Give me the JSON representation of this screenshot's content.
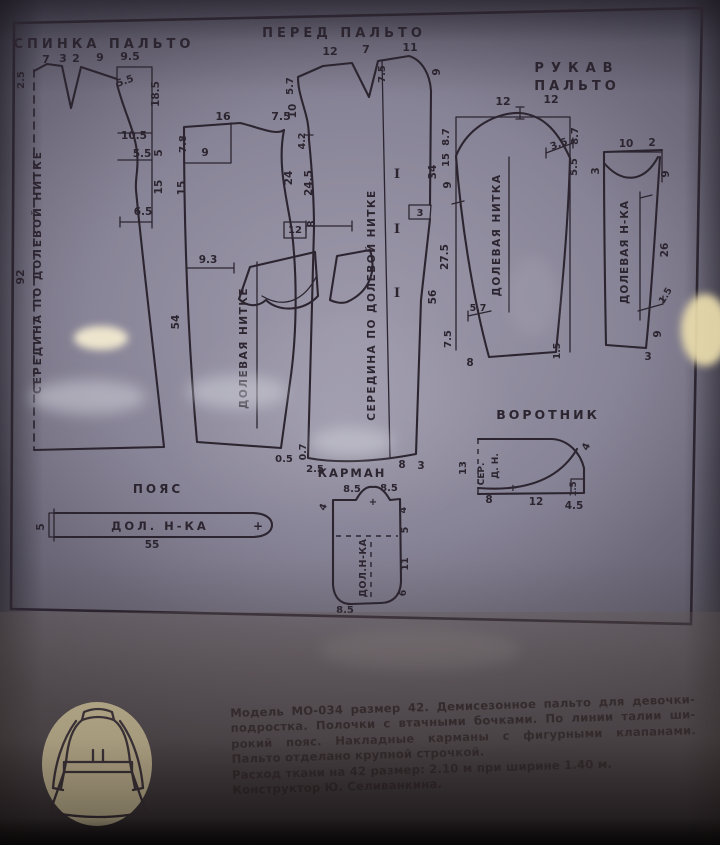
{
  "colors": {
    "line": "#2c2530",
    "logo_circle": "#e9dcae",
    "caption_text": "#221a20",
    "glare": "#f3ead0"
  },
  "sheet": {
    "titles": {
      "back": "СПИНКА ПАЛЬТО",
      "front": "ПЕРЕД ПАЛЬТО",
      "sleeve1": "РУКАВ",
      "sleeve2": "ПАЛЬТО",
      "collar": "ВОРОТНИК",
      "belt": "ПОЯС",
      "pocket": "КАРМАН"
    },
    "labels": [
      {
        "t": "7",
        "x": 46,
        "y": 63
      },
      {
        "t": "3",
        "x": 63,
        "y": 62
      },
      {
        "t": "2",
        "x": 76,
        "y": 62
      },
      {
        "t": "9",
        "x": 100,
        "y": 61
      },
      {
        "t": "9.5",
        "x": 130,
        "y": 60
      },
      {
        "t": "2.5",
        "x": 24,
        "y": 80,
        "r": -90,
        "s": 10
      },
      {
        "t": "5.5",
        "x": 126,
        "y": 84,
        "r": -20,
        "s": 10
      },
      {
        "t": "18.5",
        "x": 159,
        "y": 94,
        "r": -90,
        "s": 10.5
      },
      {
        "t": "10.5",
        "x": 134,
        "y": 139,
        "s": 10.5
      },
      {
        "t": "5.5",
        "x": 142,
        "y": 157,
        "s": 10.5
      },
      {
        "t": "5",
        "x": 162,
        "y": 153,
        "r": -90,
        "s": 10.5
      },
      {
        "t": "15",
        "x": 162,
        "y": 187,
        "r": -90,
        "s": 10.5
      },
      {
        "t": "6.5",
        "x": 143,
        "y": 215,
        "s": 10.5
      },
      {
        "t": "92",
        "x": 24,
        "y": 277,
        "r": -90,
        "s": 11
      },
      {
        "t": "СЕРЕДИНА  ПО  ДОЛЕВОЙ  НИТКЕ",
        "x": 41,
        "y": 272,
        "r": -90,
        "s": 10.5,
        "ls": 2,
        "n": "back-grainline-label"
      },
      {
        "t": "16",
        "x": 223,
        "y": 120
      },
      {
        "t": "7.5",
        "x": 281,
        "y": 120
      },
      {
        "t": "7.8",
        "x": 186,
        "y": 144,
        "r": -90,
        "s": 10
      },
      {
        "t": "15",
        "x": 185,
        "y": 188,
        "r": -90,
        "s": 10.5
      },
      {
        "t": "9",
        "x": 205,
        "y": 156,
        "s": 10.5
      },
      {
        "t": "9.3",
        "x": 208,
        "y": 263,
        "s": 10.5
      },
      {
        "t": "54",
        "x": 179,
        "y": 322,
        "r": -90,
        "s": 10.5
      },
      {
        "t": "24",
        "x": 292,
        "y": 178,
        "r": -90,
        "s": 10.5
      },
      {
        "t": "12",
        "x": 295,
        "y": 233,
        "s": 10
      },
      {
        "t": "ДОЛЕВАЯ  НИТКЕ",
        "x": 247,
        "y": 348,
        "r": -90,
        "s": 10.5,
        "ls": 1.5,
        "n": "side-grainline-label"
      },
      {
        "t": "0.5",
        "x": 284,
        "y": 462,
        "s": 10
      },
      {
        "t": "12",
        "x": 330,
        "y": 55
      },
      {
        "t": "7",
        "x": 366,
        "y": 53
      },
      {
        "t": "11",
        "x": 410,
        "y": 51
      },
      {
        "t": "5.7",
        "x": 293,
        "y": 86,
        "r": -90,
        "s": 10
      },
      {
        "t": "10",
        "x": 296,
        "y": 111,
        "r": -90,
        "s": 10.5
      },
      {
        "t": "4.2",
        "x": 305,
        "y": 141,
        "r": -90,
        "s": 9.5
      },
      {
        "t": "24.5",
        "x": 312,
        "y": 183,
        "r": -90,
        "s": 10.5
      },
      {
        "t": "8",
        "x": 315,
        "y": 224,
        "r": -90,
        "s": 10.5
      },
      {
        "t": "7.5",
        "x": 385,
        "y": 74,
        "r": -90,
        "s": 10
      },
      {
        "t": "9",
        "x": 440,
        "y": 72,
        "r": -90,
        "s": 10.5
      },
      {
        "t": "I",
        "x": 397,
        "y": 178,
        "s": 13,
        "cls": "serif"
      },
      {
        "t": "I",
        "x": 397,
        "y": 233,
        "s": 13,
        "cls": "serif"
      },
      {
        "t": "I",
        "x": 397,
        "y": 297,
        "s": 13,
        "cls": "serif"
      },
      {
        "t": "3",
        "x": 420,
        "y": 216,
        "s": 10
      },
      {
        "t": "34",
        "x": 436,
        "y": 172,
        "r": -90,
        "s": 10.5
      },
      {
        "t": "56",
        "x": 436,
        "y": 297,
        "r": -90,
        "s": 10.5
      },
      {
        "t": "СЕРЕДИНА  ПО  ДОЛЕВОЙ  НИТКЕ",
        "x": 375,
        "y": 305,
        "r": -90,
        "s": 10.5,
        "ls": 1.5,
        "n": "front-grainline-label"
      },
      {
        "t": "2.5",
        "x": 315,
        "y": 472,
        "s": 10
      },
      {
        "t": "0.7",
        "x": 306,
        "y": 452,
        "r": -90,
        "s": 9.5
      },
      {
        "t": "8",
        "x": 402,
        "y": 468,
        "s": 10.5
      },
      {
        "t": "3",
        "x": 421,
        "y": 469,
        "s": 10.5
      },
      {
        "t": "12",
        "x": 503,
        "y": 105
      },
      {
        "t": "12",
        "x": 551,
        "y": 103
      },
      {
        "t": "8.7",
        "x": 449,
        "y": 137,
        "r": -90,
        "s": 10
      },
      {
        "t": "15",
        "x": 449,
        "y": 160,
        "r": -90,
        "s": 10
      },
      {
        "t": "9",
        "x": 451,
        "y": 185,
        "r": -90,
        "s": 10.5
      },
      {
        "t": "27.5",
        "x": 448,
        "y": 257,
        "r": -90,
        "s": 10.5
      },
      {
        "t": "7.5",
        "x": 451,
        "y": 339,
        "r": -90,
        "s": 10
      },
      {
        "t": "8.7",
        "x": 578,
        "y": 136,
        "r": -90,
        "s": 10
      },
      {
        "t": "3.5",
        "x": 560,
        "y": 147,
        "r": -20,
        "s": 10
      },
      {
        "t": "5.5",
        "x": 577,
        "y": 167,
        "r": -90,
        "s": 10
      },
      {
        "t": "5.7",
        "x": 478,
        "y": 311,
        "s": 9.5
      },
      {
        "t": "8",
        "x": 470,
        "y": 366,
        "s": 10.5
      },
      {
        "t": "1.5",
        "x": 560,
        "y": 351,
        "r": -90,
        "s": 9.5
      },
      {
        "t": "ДОЛЕВАЯ  НИТКА",
        "x": 500,
        "y": 235,
        "r": -90,
        "s": 10.5,
        "ls": 1.5,
        "n": "sleeve-grainline-label"
      },
      {
        "t": "10",
        "x": 626,
        "y": 147,
        "s": 10.5
      },
      {
        "t": "2",
        "x": 652,
        "y": 146,
        "s": 10.5
      },
      {
        "t": "3",
        "x": 599,
        "y": 171,
        "r": -90,
        "s": 10.5
      },
      {
        "t": "9",
        "x": 669,
        "y": 174,
        "r": -90,
        "s": 10.5
      },
      {
        "t": "26",
        "x": 668,
        "y": 250,
        "r": -90,
        "s": 10.5
      },
      {
        "t": "1.5",
        "x": 668,
        "y": 297,
        "r": -60,
        "s": 9.5
      },
      {
        "t": "9",
        "x": 661,
        "y": 334,
        "r": -90,
        "s": 10.5
      },
      {
        "t": "3",
        "x": 648,
        "y": 360,
        "s": 10.5
      },
      {
        "t": "ДОЛЕВАЯ  Н-КА",
        "x": 628,
        "y": 252,
        "r": -90,
        "s": 10.5,
        "ls": 1,
        "n": "undersleeve-grainline-label"
      },
      {
        "t": "13",
        "x": 466,
        "y": 468,
        "r": -90,
        "s": 10
      },
      {
        "t": "СЕР.",
        "x": 484,
        "y": 474,
        "r": -90,
        "s": 9
      },
      {
        "t": "Д. Н.",
        "x": 498,
        "y": 466,
        "r": -90,
        "s": 9
      },
      {
        "t": "4",
        "x": 589,
        "y": 448,
        "r": -65,
        "s": 10
      },
      {
        "t": "1.5",
        "x": 576,
        "y": 489,
        "r": -90,
        "s": 8.5
      },
      {
        "t": "+",
        "x": 513,
        "y": 491,
        "s": 10
      },
      {
        "t": "8",
        "x": 489,
        "y": 503,
        "s": 10.5
      },
      {
        "t": "12",
        "x": 536,
        "y": 505,
        "s": 10.5
      },
      {
        "t": "4.5",
        "x": 574,
        "y": 509,
        "s": 10.5
      },
      {
        "t": "5",
        "x": 44,
        "y": 527,
        "r": -90,
        "s": 10.5
      },
      {
        "t": "ДОЛ.  Н-КА",
        "x": 160,
        "y": 530,
        "s": 11.5,
        "ls": 3,
        "n": "belt-grainline-label"
      },
      {
        "t": "+",
        "x": 258,
        "y": 530,
        "s": 12
      },
      {
        "t": "55",
        "x": 152,
        "y": 548,
        "s": 10.5
      },
      {
        "t": "8.5",
        "x": 352,
        "y": 492,
        "s": 10
      },
      {
        "t": "8.5",
        "x": 389,
        "y": 491,
        "s": 10
      },
      {
        "t": "4",
        "x": 326,
        "y": 508,
        "r": -70,
        "s": 9.5
      },
      {
        "t": "+",
        "x": 373,
        "y": 505,
        "s": 10
      },
      {
        "t": "4",
        "x": 406,
        "y": 510,
        "r": -90,
        "s": 9.5
      },
      {
        "t": "5",
        "x": 408,
        "y": 530,
        "r": -90,
        "s": 9.5
      },
      {
        "t": "11",
        "x": 408,
        "y": 564,
        "r": -90,
        "s": 9.5
      },
      {
        "t": "6",
        "x": 406,
        "y": 593,
        "r": -90,
        "s": 9.5
      },
      {
        "t": "8.5",
        "x": 345,
        "y": 613,
        "s": 10
      },
      {
        "t": "ДОЛ.Н-КА",
        "x": 366,
        "y": 568,
        "r": -90,
        "s": 9.5,
        "ls": 0.5,
        "n": "pocket-grainline-label"
      }
    ]
  },
  "footer": {
    "lines": [
      "Модель МО-034 размер 42. Демисезонное пальто для девочки-",
      "подростка. Полочки с втачными бочками. По линии талии ши-",
      "рокий пояс. Накладные карманы с фигурными клапанами.",
      "Пальто отделано крупной строчкой.",
      "Расход ткани на 42 размер: 2.10 м при ширине 1.40 м.",
      "Конструктор Ю. Селиванкина."
    ]
  }
}
